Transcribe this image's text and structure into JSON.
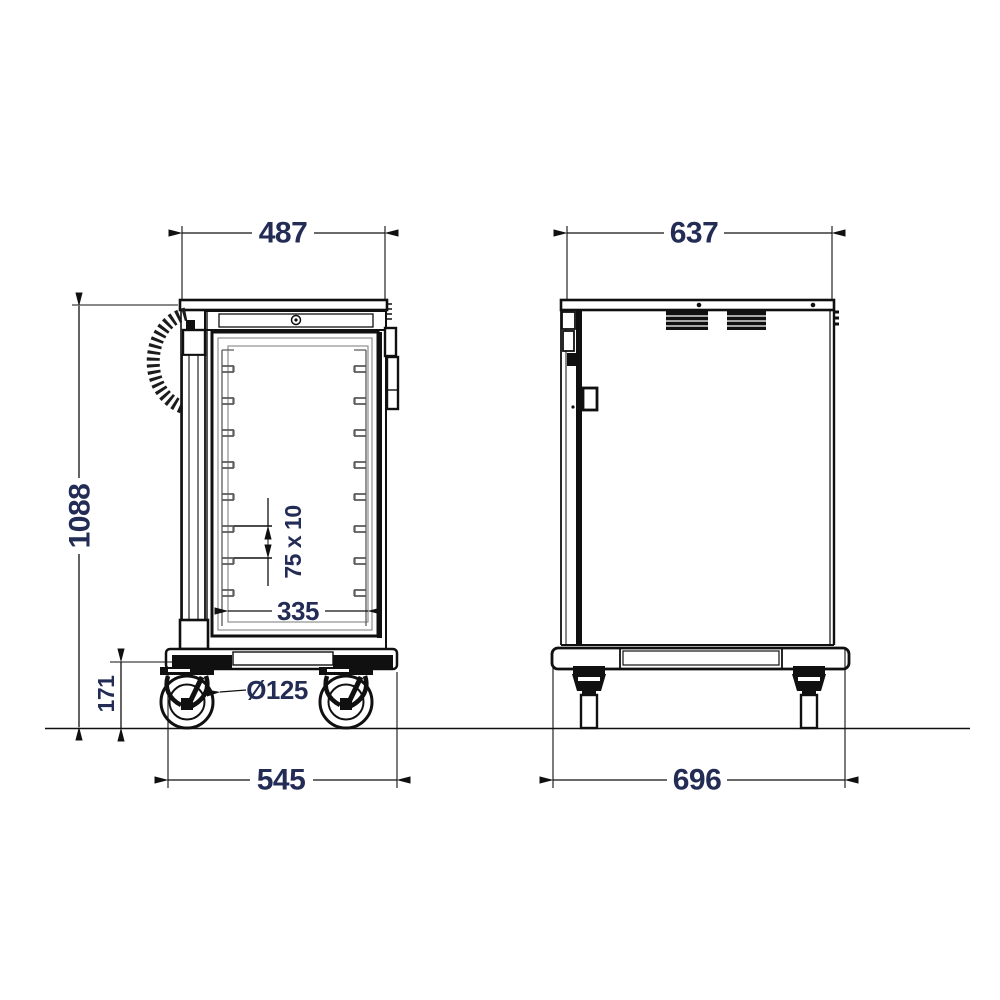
{
  "drawing": {
    "type": "technical-dimension-drawing",
    "views": {
      "front": "front-elevation",
      "side": "side-elevation"
    },
    "dimensions": {
      "front_top_width": "487",
      "side_top_depth": "637",
      "overall_height": "1088",
      "rail_slot": "75 x 10",
      "inner_clear_width": "335",
      "caster_diameter": "Ø125",
      "base_height": "171",
      "front_base_width": "545",
      "side_base_depth": "696"
    },
    "colors": {
      "line": "#101010",
      "dimension_text": "#232c55",
      "frame_gray": "#8f8f8f"
    }
  }
}
